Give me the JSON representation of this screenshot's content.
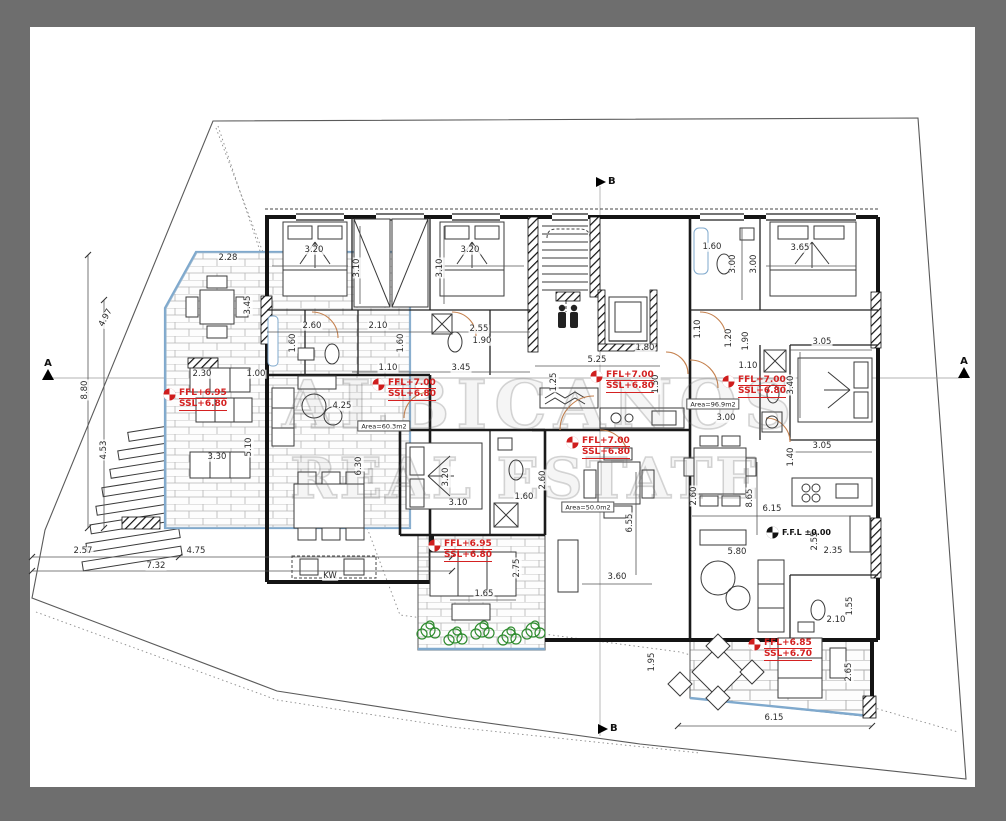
{
  "drawing": {
    "type": "architectural-floor-plan",
    "palette": {
      "frame_gray": "#6e6e6e",
      "paper": "#ffffff",
      "wall_black": "#141414",
      "accent_blue": "#7fa9cd",
      "level_red": "#d42121",
      "door_tan": "#c5814e",
      "plant_green": "#2e8b2e"
    }
  },
  "watermark": {
    "line1": "ALBICANOS",
    "line2": "REAL ESTATE"
  },
  "section_markers": [
    {
      "label": "A",
      "x": 42,
      "y": 358,
      "dir": "up"
    },
    {
      "label": "A",
      "x": 958,
      "y": 356,
      "dir": "up"
    },
    {
      "label": "B",
      "x": 596,
      "y": 176,
      "dir": "right"
    },
    {
      "label": "B",
      "x": 598,
      "y": 723,
      "dir": "right"
    }
  ],
  "level_markers": [
    {
      "line1": "FFL+6.95",
      "line2": "SSL+6.80",
      "x": 163,
      "y": 388
    },
    {
      "line1": "FFL+7.00",
      "line2": "SSL+6.80",
      "x": 372,
      "y": 378
    },
    {
      "line1": "FFL+7.00",
      "line2": "SSL+6.80",
      "x": 590,
      "y": 370
    },
    {
      "line1": "FFL+7.00",
      "line2": "SSL+6.80",
      "x": 722,
      "y": 375
    },
    {
      "line1": "FFL+7.00",
      "line2": "SSL+6.80",
      "x": 566,
      "y": 436
    },
    {
      "line1": "FFL+6.95",
      "line2": "SSL+6.80",
      "x": 428,
      "y": 539
    },
    {
      "line1": "FFL+6.85",
      "line2": "SSL+6.70",
      "x": 748,
      "y": 638
    }
  ],
  "datum_marker": {
    "text": "F.F.L ±0.00",
    "x": 766,
    "y": 526
  },
  "area_labels": [
    {
      "text": "Area=60.3m2",
      "x": 384,
      "y": 426
    },
    {
      "text": "Area=96.9m2",
      "x": 713,
      "y": 404
    },
    {
      "text": "Area=50.0m2",
      "x": 588,
      "y": 507
    }
  ],
  "dimensions": [
    {
      "t": "2.28",
      "x": 228,
      "y": 258,
      "r": 0
    },
    {
      "t": "3.20",
      "x": 314,
      "y": 250,
      "r": 0
    },
    {
      "t": "3.20",
      "x": 470,
      "y": 250,
      "r": 0
    },
    {
      "t": "1.60",
      "x": 712,
      "y": 247,
      "r": 0
    },
    {
      "t": "3.65",
      "x": 800,
      "y": 248,
      "r": 0
    },
    {
      "t": "3.10",
      "x": 357,
      "y": 268,
      "r": -90
    },
    {
      "t": "3.10",
      "x": 440,
      "y": 268,
      "r": -90
    },
    {
      "t": "3.00",
      "x": 733,
      "y": 264,
      "r": -90
    },
    {
      "t": "3.00",
      "x": 754,
      "y": 264,
      "r": -90
    },
    {
      "t": "2.60",
      "x": 312,
      "y": 326,
      "r": 0
    },
    {
      "t": "2.10",
      "x": 378,
      "y": 326,
      "r": 0
    },
    {
      "t": "2.55",
      "x": 479,
      "y": 329,
      "r": 0
    },
    {
      "t": "1.90",
      "x": 482,
      "y": 341,
      "r": 0
    },
    {
      "t": "1.60",
      "x": 293,
      "y": 343,
      "r": -90
    },
    {
      "t": "1.60",
      "x": 401,
      "y": 343,
      "r": -90
    },
    {
      "t": "1.10",
      "x": 698,
      "y": 329,
      "r": -90
    },
    {
      "t": "1.20",
      "x": 729,
      "y": 338,
      "r": -90
    },
    {
      "t": "1.90",
      "x": 746,
      "y": 341,
      "r": -90
    },
    {
      "t": "1.80",
      "x": 645,
      "y": 348,
      "r": 0
    },
    {
      "t": "5.25",
      "x": 597,
      "y": 360,
      "r": 0
    },
    {
      "t": "1.25",
      "x": 554,
      "y": 382,
      "r": -90
    },
    {
      "t": "1.50",
      "x": 656,
      "y": 384,
      "r": -90
    },
    {
      "t": "1.10",
      "x": 388,
      "y": 368,
      "r": 0
    },
    {
      "t": "3.45",
      "x": 461,
      "y": 368,
      "r": 0
    },
    {
      "t": "2.30",
      "x": 202,
      "y": 374,
      "r": 0
    },
    {
      "t": "1.00",
      "x": 256,
      "y": 374,
      "r": 0
    },
    {
      "t": "3.45",
      "x": 248,
      "y": 305,
      "r": -90
    },
    {
      "t": "5.10",
      "x": 249,
      "y": 447,
      "r": -90
    },
    {
      "t": "8.80",
      "x": 85,
      "y": 390,
      "r": -90
    },
    {
      "t": "4.53",
      "x": 104,
      "y": 450,
      "r": -90
    },
    {
      "t": "4.97",
      "x": 106,
      "y": 318,
      "r": -62
    },
    {
      "t": "1.10",
      "x": 748,
      "y": 366,
      "r": 0
    },
    {
      "t": "3.05",
      "x": 822,
      "y": 342,
      "r": 0
    },
    {
      "t": "3.40",
      "x": 791,
      "y": 385,
      "r": -90
    },
    {
      "t": "3.05",
      "x": 822,
      "y": 446,
      "r": 0
    },
    {
      "t": "3.00",
      "x": 726,
      "y": 418,
      "r": 0
    },
    {
      "t": "1.40",
      "x": 791,
      "y": 457,
      "r": -90
    },
    {
      "t": "4.25",
      "x": 342,
      "y": 406,
      "r": 0
    },
    {
      "t": "6.30",
      "x": 359,
      "y": 466,
      "r": -90
    },
    {
      "t": "3.20",
      "x": 446,
      "y": 477,
      "r": -90
    },
    {
      "t": "2.60",
      "x": 543,
      "y": 480,
      "r": -90
    },
    {
      "t": "2.60",
      "x": 694,
      "y": 496,
      "r": -90
    },
    {
      "t": "3.30",
      "x": 217,
      "y": 457,
      "r": 0
    },
    {
      "t": "3.10",
      "x": 458,
      "y": 503,
      "r": 0
    },
    {
      "t": "1.60",
      "x": 524,
      "y": 497,
      "r": 0
    },
    {
      "t": "2.57",
      "x": 83,
      "y": 551,
      "r": 0
    },
    {
      "t": "4.75",
      "x": 196,
      "y": 551,
      "r": 0
    },
    {
      "t": "7.32",
      "x": 156,
      "y": 566,
      "r": 0
    },
    {
      "t": "1.65",
      "x": 484,
      "y": 594,
      "r": 0
    },
    {
      "t": "2.75",
      "x": 517,
      "y": 568,
      "r": -90
    },
    {
      "t": "3.60",
      "x": 617,
      "y": 577,
      "r": 0
    },
    {
      "t": "6.55",
      "x": 630,
      "y": 523,
      "r": -90
    },
    {
      "t": "1.95",
      "x": 652,
      "y": 662,
      "r": -90
    },
    {
      "t": "6.15",
      "x": 772,
      "y": 509,
      "r": 0
    },
    {
      "t": "8.65",
      "x": 750,
      "y": 498,
      "r": -90
    },
    {
      "t": "2.55",
      "x": 815,
      "y": 541,
      "r": -90
    },
    {
      "t": "2.35",
      "x": 833,
      "y": 551,
      "r": 0
    },
    {
      "t": "5.80",
      "x": 737,
      "y": 552,
      "r": 0
    },
    {
      "t": "2.10",
      "x": 836,
      "y": 620,
      "r": 0
    },
    {
      "t": "1.55",
      "x": 850,
      "y": 606,
      "r": -90
    },
    {
      "t": "2.65",
      "x": 849,
      "y": 672,
      "r": -90
    },
    {
      "t": "6.15",
      "x": 774,
      "y": 718,
      "r": 0
    },
    {
      "t": "KW",
      "x": 330,
      "y": 576,
      "r": 0
    }
  ]
}
